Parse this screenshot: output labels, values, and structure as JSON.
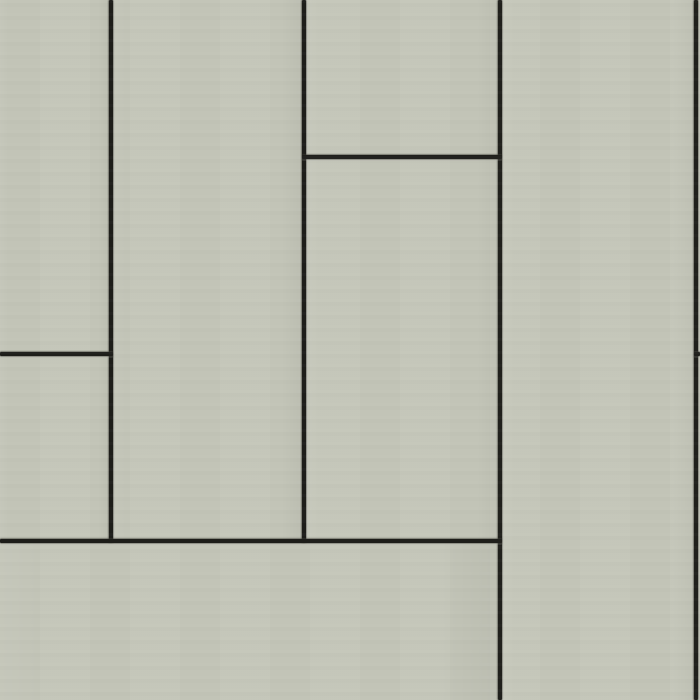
{
  "scene": {
    "kind": "material-texture-photo",
    "subject": "vertical cladding panels with staggered open joints",
    "panel_color": "#c4c6b9",
    "panel_color_light": "#c9cbbe",
    "panel_color_dark": "#bcbeb1",
    "joint_color": "#1d1d19",
    "canvas_width": 700,
    "canvas_height": 700
  },
  "panels": [
    {
      "id": "panel-top-left",
      "x": 0,
      "y": 0,
      "w": 111,
      "h": 354
    },
    {
      "id": "panel-mid-left",
      "x": 0,
      "y": 354,
      "w": 111,
      "h": 187
    },
    {
      "id": "panel-column-2",
      "x": 111,
      "y": 0,
      "w": 193,
      "h": 541
    },
    {
      "id": "panel-column-3-top",
      "x": 304,
      "y": 0,
      "w": 196,
      "h": 157
    },
    {
      "id": "panel-column-3-main",
      "x": 304,
      "y": 157,
      "w": 196,
      "h": 384
    },
    {
      "id": "panel-column-4",
      "x": 500,
      "y": 0,
      "w": 196,
      "h": 700
    },
    {
      "id": "panel-bottom-strip",
      "x": 0,
      "y": 541,
      "w": 500,
      "h": 159
    },
    {
      "id": "panel-right-sliver-top",
      "x": 696,
      "y": 0,
      "w": 4,
      "h": 354
    },
    {
      "id": "panel-right-sliver-bottom",
      "x": 696,
      "y": 354,
      "w": 4,
      "h": 346
    }
  ],
  "joints": {
    "thickness": 4,
    "vertical": [
      {
        "id": "joint-v1",
        "x": 109,
        "y": 0,
        "length": 543
      },
      {
        "id": "joint-v2",
        "x": 302,
        "y": 0,
        "length": 543
      },
      {
        "id": "joint-v3",
        "x": 498,
        "y": 0,
        "length": 700
      },
      {
        "id": "joint-v4",
        "x": 694,
        "y": 0,
        "length": 700
      }
    ],
    "horizontal": [
      {
        "id": "joint-h1",
        "x": 302,
        "y": 155,
        "length": 200
      },
      {
        "id": "joint-h2",
        "x": 0,
        "y": 352,
        "length": 113
      },
      {
        "id": "joint-h3",
        "x": 694,
        "y": 352,
        "length": 6
      },
      {
        "id": "joint-h4",
        "x": 0,
        "y": 539,
        "length": 502
      }
    ]
  }
}
